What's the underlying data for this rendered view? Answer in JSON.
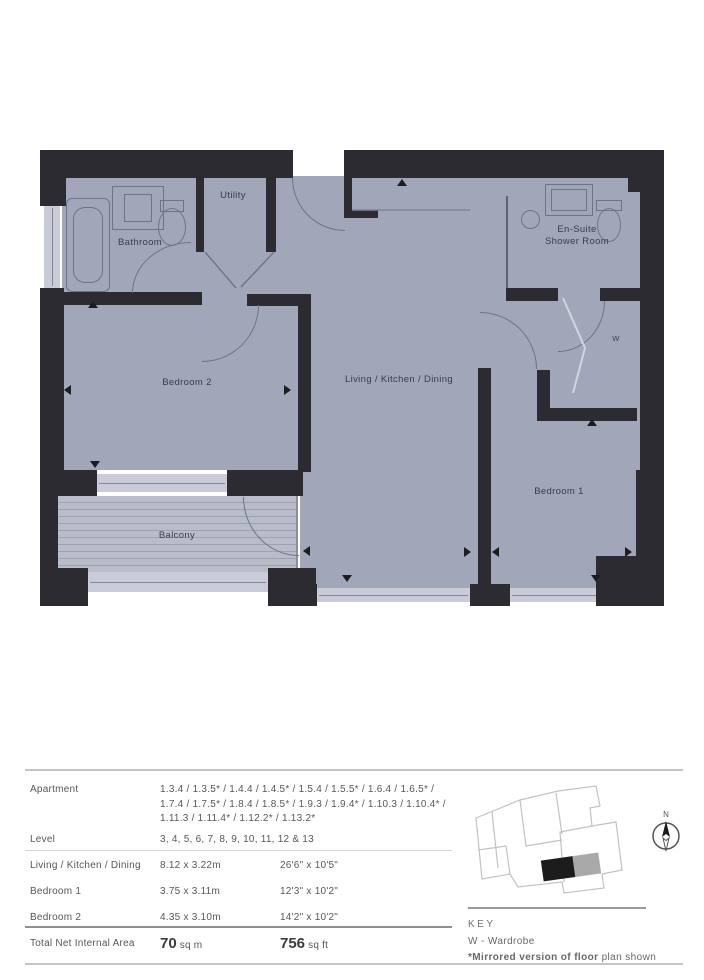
{
  "plan": {
    "rooms": {
      "bathroom": "Bathroom",
      "utility": "Utility",
      "bedroom2": "Bedroom 2",
      "living": "Living / Kitchen / Dining",
      "ensuite_line1": "En-Suite",
      "ensuite_line2": "Shower Room",
      "bedroom1": "Bedroom 1",
      "balcony": "Balcony",
      "wardrobe": "W"
    },
    "colors": {
      "wall": "#2b2b31",
      "floor": "#a2a6b9",
      "window": "#c9ccd8",
      "fixture_outline": "#6e7488"
    }
  },
  "table": {
    "rows": [
      {
        "label": "Apartment",
        "value": "1.3.4 / 1.3.5* / 1.4.4 / 1.4.5* / 1.5.4 / 1.5.5* / 1.6.4 / 1.6.5* / 1.7.4 / 1.7.5* / 1.8.4 / 1.8.5* / 1.9.3 / 1.9.4* / 1.10.3 / 1.10.4* / 1.11.3 / 1.11.4* / 1.12.2* / 1.13.2*"
      },
      {
        "label": "Level",
        "value": "3, 4, 5, 6, 7, 8, 9, 10, 11, 12 & 13"
      }
    ],
    "dim_rows": [
      {
        "label": "Living / Kitchen / Dining",
        "metric": "8.12 x 3.22m",
        "imperial": "26'6\" x 10'5\""
      },
      {
        "label": "Bedroom 1",
        "metric": "3.75 x 3.11m",
        "imperial": "12'3\" x 10'2\""
      },
      {
        "label": "Bedroom 2",
        "metric": "4.35 x 3.10m",
        "imperial": "14'2\" x 10'2\""
      }
    ],
    "total": {
      "label": "Total Net Internal Area",
      "metric_value": "70",
      "metric_unit": "sq m",
      "imperial_value": "756",
      "imperial_unit": "sq ft"
    }
  },
  "key": {
    "title": "KEY",
    "wardrobe": "W - Wardrobe",
    "note_bold": "*Mirrored version of floor",
    "note_regular": " plan shown",
    "compass_n": "N"
  }
}
